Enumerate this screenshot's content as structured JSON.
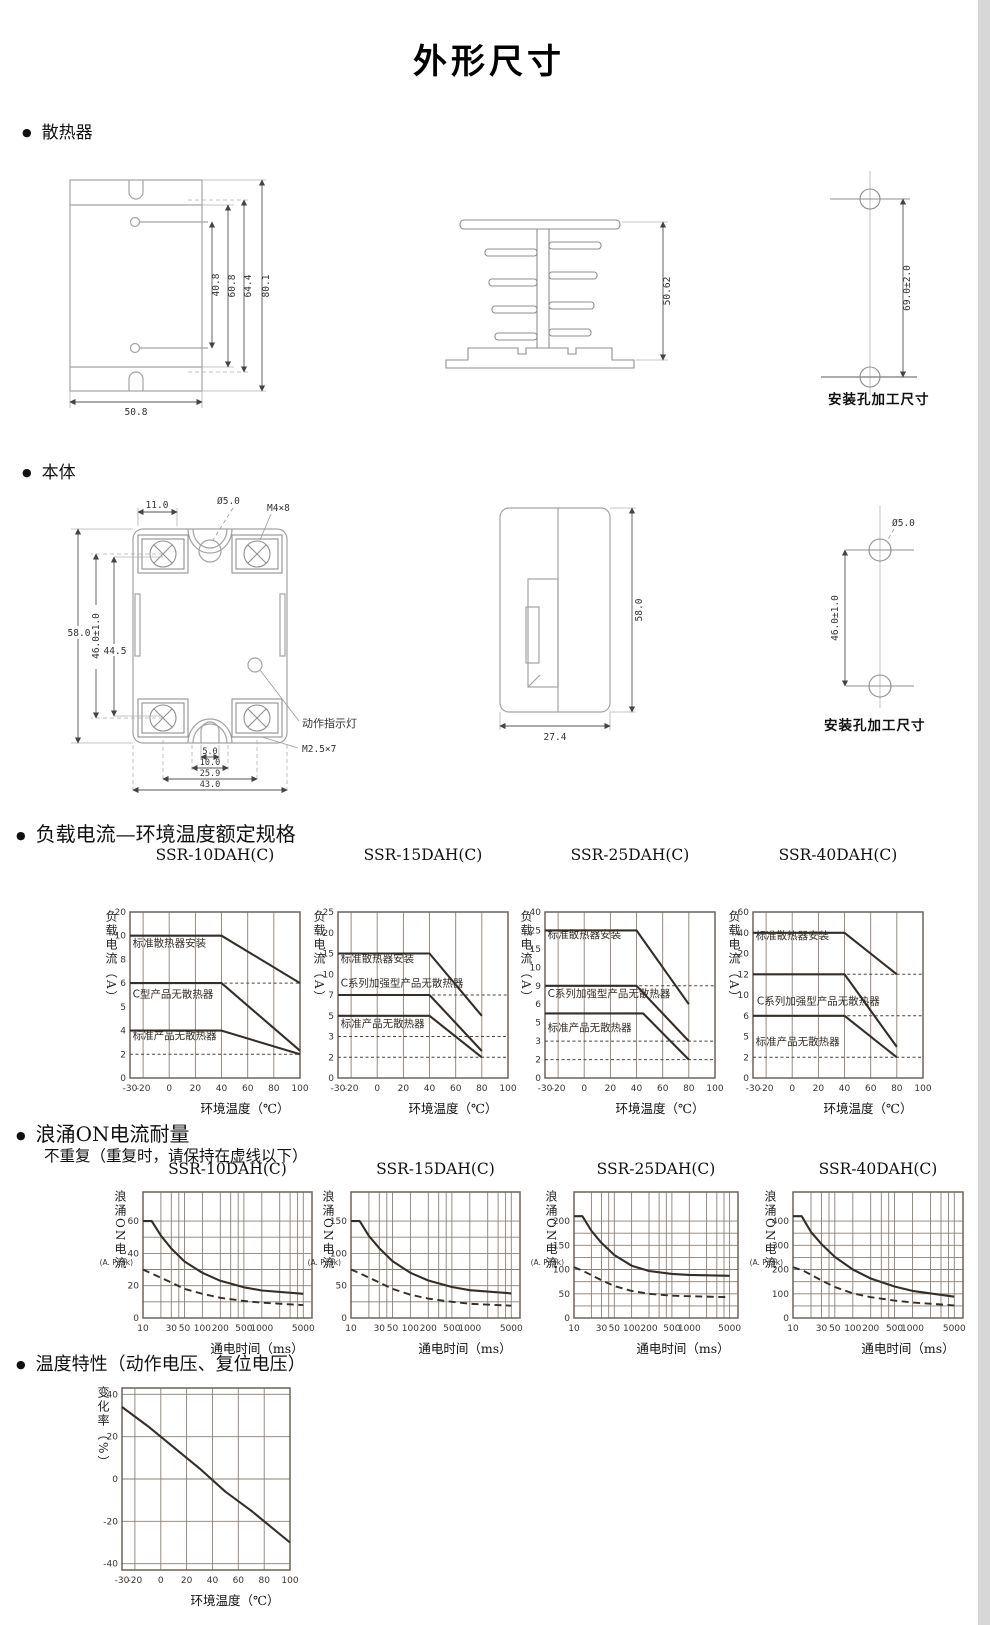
{
  "page": {
    "title": "外形尺寸"
  },
  "sections": {
    "heatsink": {
      "label": "散热器"
    },
    "body": {
      "label": "本体"
    },
    "derating": {
      "label": "负载电流—环境温度额定规格"
    },
    "surge": {
      "label": "浪涌ON电流耐量",
      "note": "不重复（重复时，请保持在虚线以下）"
    },
    "temp": {
      "label": "温度特性（动作电压、复位电压）"
    }
  },
  "drawings": {
    "heatsink_front": {
      "dims": {
        "hole_pitch": "40.8",
        "fin_span": "60.8",
        "slot_span": "64.4",
        "height": "80.1",
        "width": "50.8"
      }
    },
    "heatsink_profile": {
      "dims": {
        "height": "50.62"
      }
    },
    "heatsink_holes": {
      "dims": {
        "pitch": "69.0±2.0"
      },
      "caption": "安装孔加工尺寸"
    },
    "body_front": {
      "dims": {
        "tab": "11.0",
        "hole": "Ø5.0",
        "screw_top": "M4×8",
        "height": "58.0",
        "mount_pitch": "46.0±1.0",
        "terminal_pitch": "44.5",
        "slot_a": "5.0",
        "slot_b": "10.0",
        "screw_pitch": "25.9",
        "width": "43.0"
      },
      "labels": {
        "indicator": "动作指示灯",
        "screw_bottom": "M2.5×7"
      }
    },
    "body_side": {
      "dims": {
        "height": "58.0",
        "width": "27.4"
      }
    },
    "body_holes": {
      "dims": {
        "hole": "Ø5.0",
        "pitch": "46.0±1.0"
      },
      "caption": "安装孔加工尺寸"
    }
  },
  "chart_data": [
    {
      "id": "d10",
      "type": "line",
      "group": "derating",
      "title": "SSR-10DAH(C)",
      "xlabel": "环境温度（℃）",
      "ylabel": "负载电流（A）",
      "xscale": "linear",
      "xlim": [
        -30,
        100
      ],
      "xticks": [
        -30,
        -20,
        0,
        20,
        40,
        60,
        80,
        100
      ],
      "xtick_labels": [
        "-30",
        "-20",
        "0",
        "20",
        "40",
        "60",
        "80",
        "100"
      ],
      "yscale": "ticks",
      "yticks": [
        0,
        2,
        4,
        5,
        6,
        8,
        10,
        20
      ],
      "series": [
        {
          "name": "标准散热器安装",
          "style": "solid",
          "label_xy": [
            -28,
            9.1
          ],
          "points": [
            [
              -30,
              10
            ],
            [
              40,
              10
            ],
            [
              100,
              6
            ]
          ]
        },
        {
          "name": "C型产品无散热器",
          "style": "solid",
          "label_xy": [
            -28,
            5.4
          ],
          "points": [
            [
              -30,
              6
            ],
            [
              40,
              6
            ],
            [
              100,
              2.3
            ]
          ]
        },
        {
          "name": "标准产品无散热器",
          "style": "solid",
          "label_xy": [
            -28,
            3.3
          ],
          "points": [
            [
              -30,
              4
            ],
            [
              40,
              4
            ],
            [
              100,
              2
            ]
          ]
        }
      ],
      "guides": [
        {
          "y": 6,
          "x1": 42,
          "x2": 100
        },
        {
          "y": 2,
          "x1": -30,
          "x2": 100
        }
      ]
    },
    {
      "id": "d15",
      "type": "line",
      "group": "derating",
      "title": "SSR-15DAH(C)",
      "xlabel": "环境温度（℃）",
      "ylabel": "负载电流（A）",
      "xscale": "linear",
      "xlim": [
        -30,
        100
      ],
      "xticks": [
        -30,
        -20,
        0,
        20,
        40,
        60,
        80,
        100
      ],
      "xtick_labels": [
        "-30",
        "-20",
        "0",
        "20",
        "40",
        "60",
        "80",
        "100"
      ],
      "yscale": "ticks",
      "yticks": [
        0,
        2,
        3,
        5,
        7,
        10,
        15,
        20,
        25
      ],
      "series": [
        {
          "name": "标准散热器安装",
          "style": "solid",
          "label_xy": [
            -28,
            13
          ],
          "points": [
            [
              -30,
              15
            ],
            [
              40,
              15
            ],
            [
              80,
              5
            ]
          ]
        },
        {
          "name": "C系列加强型产品无散热器",
          "style": "solid",
          "label_xy": [
            -28,
            8.2
          ],
          "points": [
            [
              -30,
              7
            ],
            [
              40,
              7
            ],
            [
              80,
              2.3
            ]
          ]
        },
        {
          "name": "标准产品无散热器",
          "style": "solid",
          "label_xy": [
            -28,
            3.9
          ],
          "points": [
            [
              -30,
              5
            ],
            [
              40,
              5
            ],
            [
              80,
              2
            ]
          ]
        }
      ],
      "guides": [
        {
          "y": 7,
          "x1": 42,
          "x2": 100
        },
        {
          "y": 3,
          "x1": -30,
          "x2": 100
        },
        {
          "y": 2,
          "x1": -30,
          "x2": 100
        }
      ]
    },
    {
      "id": "d25",
      "type": "line",
      "group": "derating",
      "title": "SSR-25DAH(C)",
      "xlabel": "环境温度（℃）",
      "ylabel": "负载电流（A）",
      "xscale": "linear",
      "xlim": [
        -30,
        100
      ],
      "xticks": [
        -30,
        -20,
        0,
        20,
        40,
        60,
        80,
        100
      ],
      "xtick_labels": [
        "-30",
        "-20",
        "0",
        "20",
        "40",
        "60",
        "80",
        "100"
      ],
      "yscale": "ticks",
      "yticks": [
        0,
        2,
        3,
        5,
        6,
        9,
        10,
        15,
        25,
        40
      ],
      "series": [
        {
          "name": "标准散热器安装",
          "style": "solid",
          "label_xy": [
            -28,
            21
          ],
          "points": [
            [
              -30,
              25
            ],
            [
              40,
              25
            ],
            [
              80,
              6
            ]
          ]
        },
        {
          "name": "C系列加强型产品无散热器",
          "style": "solid",
          "label_xy": [
            -28,
            7.2
          ],
          "points": [
            [
              -30,
              9
            ],
            [
              40,
              9
            ],
            [
              80,
              3
            ]
          ]
        },
        {
          "name": "标准产品无散热器",
          "style": "solid",
          "label_xy": [
            -28,
            4.1
          ],
          "points": [
            [
              -30,
              5.5
            ],
            [
              45,
              5.5
            ],
            [
              80,
              2
            ]
          ]
        }
      ],
      "guides": [
        {
          "y": 9,
          "x1": 42,
          "x2": 100
        },
        {
          "y": 3,
          "x1": -30,
          "x2": 100
        },
        {
          "y": 2,
          "x1": -30,
          "x2": 100
        }
      ]
    },
    {
      "id": "d40",
      "type": "line",
      "group": "derating",
      "title": "SSR-40DAH(C)",
      "xlabel": "环境温度（℃）",
      "ylabel": "负载电流（A）",
      "xscale": "linear",
      "xlim": [
        -30,
        100
      ],
      "xticks": [
        -30,
        -20,
        0,
        20,
        40,
        60,
        80,
        100
      ],
      "xtick_labels": [
        "-30",
        "-20",
        "0",
        "20",
        "40",
        "60",
        "80",
        "100"
      ],
      "yscale": "ticks",
      "yticks": [
        0,
        2,
        5,
        6,
        10,
        12,
        20,
        40,
        60
      ],
      "series": [
        {
          "name": "标准散热器安装",
          "style": "solid",
          "label_xy": [
            -28,
            34
          ],
          "points": [
            [
              -30,
              40
            ],
            [
              40,
              40
            ],
            [
              80,
              12
            ]
          ]
        },
        {
          "name": "C系列加强型产品无散热器",
          "style": "solid",
          "label_xy": [
            -27,
            8.2
          ],
          "points": [
            [
              -30,
              12
            ],
            [
              40,
              12
            ],
            [
              80,
              3.5
            ]
          ]
        },
        {
          "name": "标准产品无散热器",
          "style": "solid",
          "label_xy": [
            -28,
            3.8
          ],
          "points": [
            [
              -30,
              6
            ],
            [
              40,
              6
            ],
            [
              80,
              2
            ]
          ]
        }
      ],
      "guides": [
        {
          "y": 12,
          "x1": 42,
          "x2": 100
        },
        {
          "y": 6,
          "x1": 42,
          "x2": 100
        },
        {
          "y": 2,
          "x1": -30,
          "x2": 100
        }
      ]
    },
    {
      "id": "s10",
      "type": "line",
      "group": "surge",
      "title": "SSR-10DAH(C)",
      "xlabel": "通电时间（ms）",
      "ylabel": "浪涌ON电流",
      "ylabel2": "(A. Peak)",
      "xscale": "log",
      "xlim": [
        10,
        7000
      ],
      "xticks": [
        10,
        30,
        50,
        100,
        200,
        500,
        1000,
        5000
      ],
      "xtick_labels": [
        "10",
        "30",
        "50",
        "100",
        "200",
        "500",
        "1000",
        "5000"
      ],
      "yscale": "linear",
      "ylim": 78,
      "yticks": [
        0,
        20,
        40,
        60
      ],
      "series": [
        {
          "name": "不重复",
          "style": "solid",
          "points": [
            [
              10,
              60
            ],
            [
              14,
              60
            ],
            [
              20,
              51
            ],
            [
              30,
              43
            ],
            [
              50,
              35
            ],
            [
              100,
              28
            ],
            [
              200,
              23
            ],
            [
              500,
              19
            ],
            [
              1000,
              17
            ],
            [
              5000,
              15
            ]
          ]
        },
        {
          "name": "重复时上限",
          "style": "dashed",
          "points": [
            [
              10,
              30
            ],
            [
              15,
              27
            ],
            [
              30,
              22
            ],
            [
              50,
              18
            ],
            [
              100,
              15
            ],
            [
              200,
              12.5
            ],
            [
              500,
              10.5
            ],
            [
              1000,
              9.5
            ],
            [
              5000,
              8
            ]
          ]
        }
      ]
    },
    {
      "id": "s15",
      "type": "line",
      "group": "surge",
      "title": "SSR-15DAH(C)",
      "xlabel": "通电时间（ms）",
      "ylabel": "浪涌ON电流",
      "ylabel2": "(A. Peak)",
      "xscale": "log",
      "xlim": [
        10,
        7000
      ],
      "xticks": [
        10,
        30,
        50,
        100,
        200,
        500,
        1000,
        5000
      ],
      "xtick_labels": [
        "10",
        "30",
        "50",
        "100",
        "200",
        "500",
        "1000",
        "5000"
      ],
      "yscale": "linear",
      "ylim": 195,
      "yticks": [
        0,
        50,
        100,
        150
      ],
      "series": [
        {
          "name": "不重复",
          "style": "solid",
          "points": [
            [
              10,
              150
            ],
            [
              14,
              150
            ],
            [
              20,
              127
            ],
            [
              30,
              108
            ],
            [
              50,
              88
            ],
            [
              100,
              70
            ],
            [
              200,
              58
            ],
            [
              500,
              48
            ],
            [
              1000,
              43
            ],
            [
              5000,
              38
            ]
          ]
        },
        {
          "name": "重复时上限",
          "style": "dashed",
          "points": [
            [
              10,
              75
            ],
            [
              15,
              68
            ],
            [
              30,
              55
            ],
            [
              50,
              45
            ],
            [
              100,
              36
            ],
            [
              200,
              30
            ],
            [
              500,
              25
            ],
            [
              1000,
              22
            ],
            [
              5000,
              19
            ]
          ]
        }
      ]
    },
    {
      "id": "s25",
      "type": "line",
      "group": "surge",
      "title": "SSR-25DAH(C)",
      "xlabel": "通电时间（ms）",
      "ylabel": "浪涌ON电流",
      "ylabel2": "(A. Peak)",
      "xscale": "log",
      "xlim": [
        10,
        7000
      ],
      "xticks": [
        10,
        30,
        50,
        100,
        200,
        500,
        1000,
        5000
      ],
      "xtick_labels": [
        "10",
        "30",
        "50",
        "100",
        "200",
        "500",
        "1000",
        "5000"
      ],
      "yscale": "linear",
      "ylim": 260,
      "yticks": [
        0,
        50,
        100,
        150,
        200
      ],
      "series": [
        {
          "name": "不重复",
          "style": "solid",
          "points": [
            [
              10,
              210
            ],
            [
              14,
              210
            ],
            [
              20,
              180
            ],
            [
              30,
              155
            ],
            [
              50,
              130
            ],
            [
              100,
              108
            ],
            [
              200,
              97
            ],
            [
              500,
              91
            ],
            [
              1000,
              89
            ],
            [
              5000,
              87
            ]
          ]
        },
        {
          "name": "重复时上限",
          "style": "dashed",
          "points": [
            [
              10,
              105
            ],
            [
              15,
              96
            ],
            [
              30,
              78
            ],
            [
              50,
              66
            ],
            [
              100,
              56
            ],
            [
              200,
              50
            ],
            [
              500,
              46
            ],
            [
              1000,
              45
            ],
            [
              5000,
              43
            ]
          ]
        }
      ]
    },
    {
      "id": "s40",
      "type": "line",
      "group": "surge",
      "title": "SSR-40DAH(C)",
      "xlabel": "通电时间（ms）",
      "ylabel": "浪涌ON电流",
      "ylabel2": "(A. Peak)",
      "xscale": "log",
      "xlim": [
        10,
        7000
      ],
      "xticks": [
        10,
        30,
        50,
        100,
        200,
        500,
        1000,
        5000
      ],
      "xtick_labels": [
        "10",
        "30",
        "50",
        "100",
        "200",
        "500",
        "1000",
        "5000"
      ],
      "yscale": "linear",
      "ylim": 520,
      "yticks": [
        0,
        100,
        200,
        300,
        400
      ],
      "series": [
        {
          "name": "不重复",
          "style": "solid",
          "points": [
            [
              10,
              420
            ],
            [
              14,
              420
            ],
            [
              20,
              355
            ],
            [
              30,
              305
            ],
            [
              50,
              252
            ],
            [
              100,
              200
            ],
            [
              200,
              163
            ],
            [
              500,
              130
            ],
            [
              1000,
              112
            ],
            [
              5000,
              88
            ]
          ]
        },
        {
          "name": "重复时上限",
          "style": "dashed",
          "points": [
            [
              10,
              210
            ],
            [
              15,
              195
            ],
            [
              30,
              155
            ],
            [
              50,
              128
            ],
            [
              100,
              102
            ],
            [
              200,
              86
            ],
            [
              500,
              72
            ],
            [
              1000,
              64
            ],
            [
              5000,
              52
            ]
          ]
        }
      ]
    },
    {
      "id": "temp",
      "type": "line",
      "group": "temp",
      "title": "",
      "xlabel": "环境温度（℃）",
      "ylabel": "变化率（%）",
      "xscale": "linear",
      "xlim": [
        -30,
        100
      ],
      "xticks": [
        -30,
        -20,
        0,
        20,
        40,
        60,
        80,
        100
      ],
      "xtick_labels": [
        "-30",
        "-20",
        "0",
        "20",
        "40",
        "60",
        "80",
        "100"
      ],
      "yscale": "linear",
      "ylim": [
        -43,
        43
      ],
      "yticks": [
        -40,
        -20,
        0,
        20,
        40
      ],
      "series": [
        {
          "name": "",
          "style": "solid",
          "points": [
            [
              -30,
              34
            ],
            [
              -10,
              25
            ],
            [
              10,
              15
            ],
            [
              30,
              5
            ],
            [
              50,
              -6
            ],
            [
              70,
              -15
            ],
            [
              100,
              -30
            ]
          ]
        }
      ]
    }
  ]
}
